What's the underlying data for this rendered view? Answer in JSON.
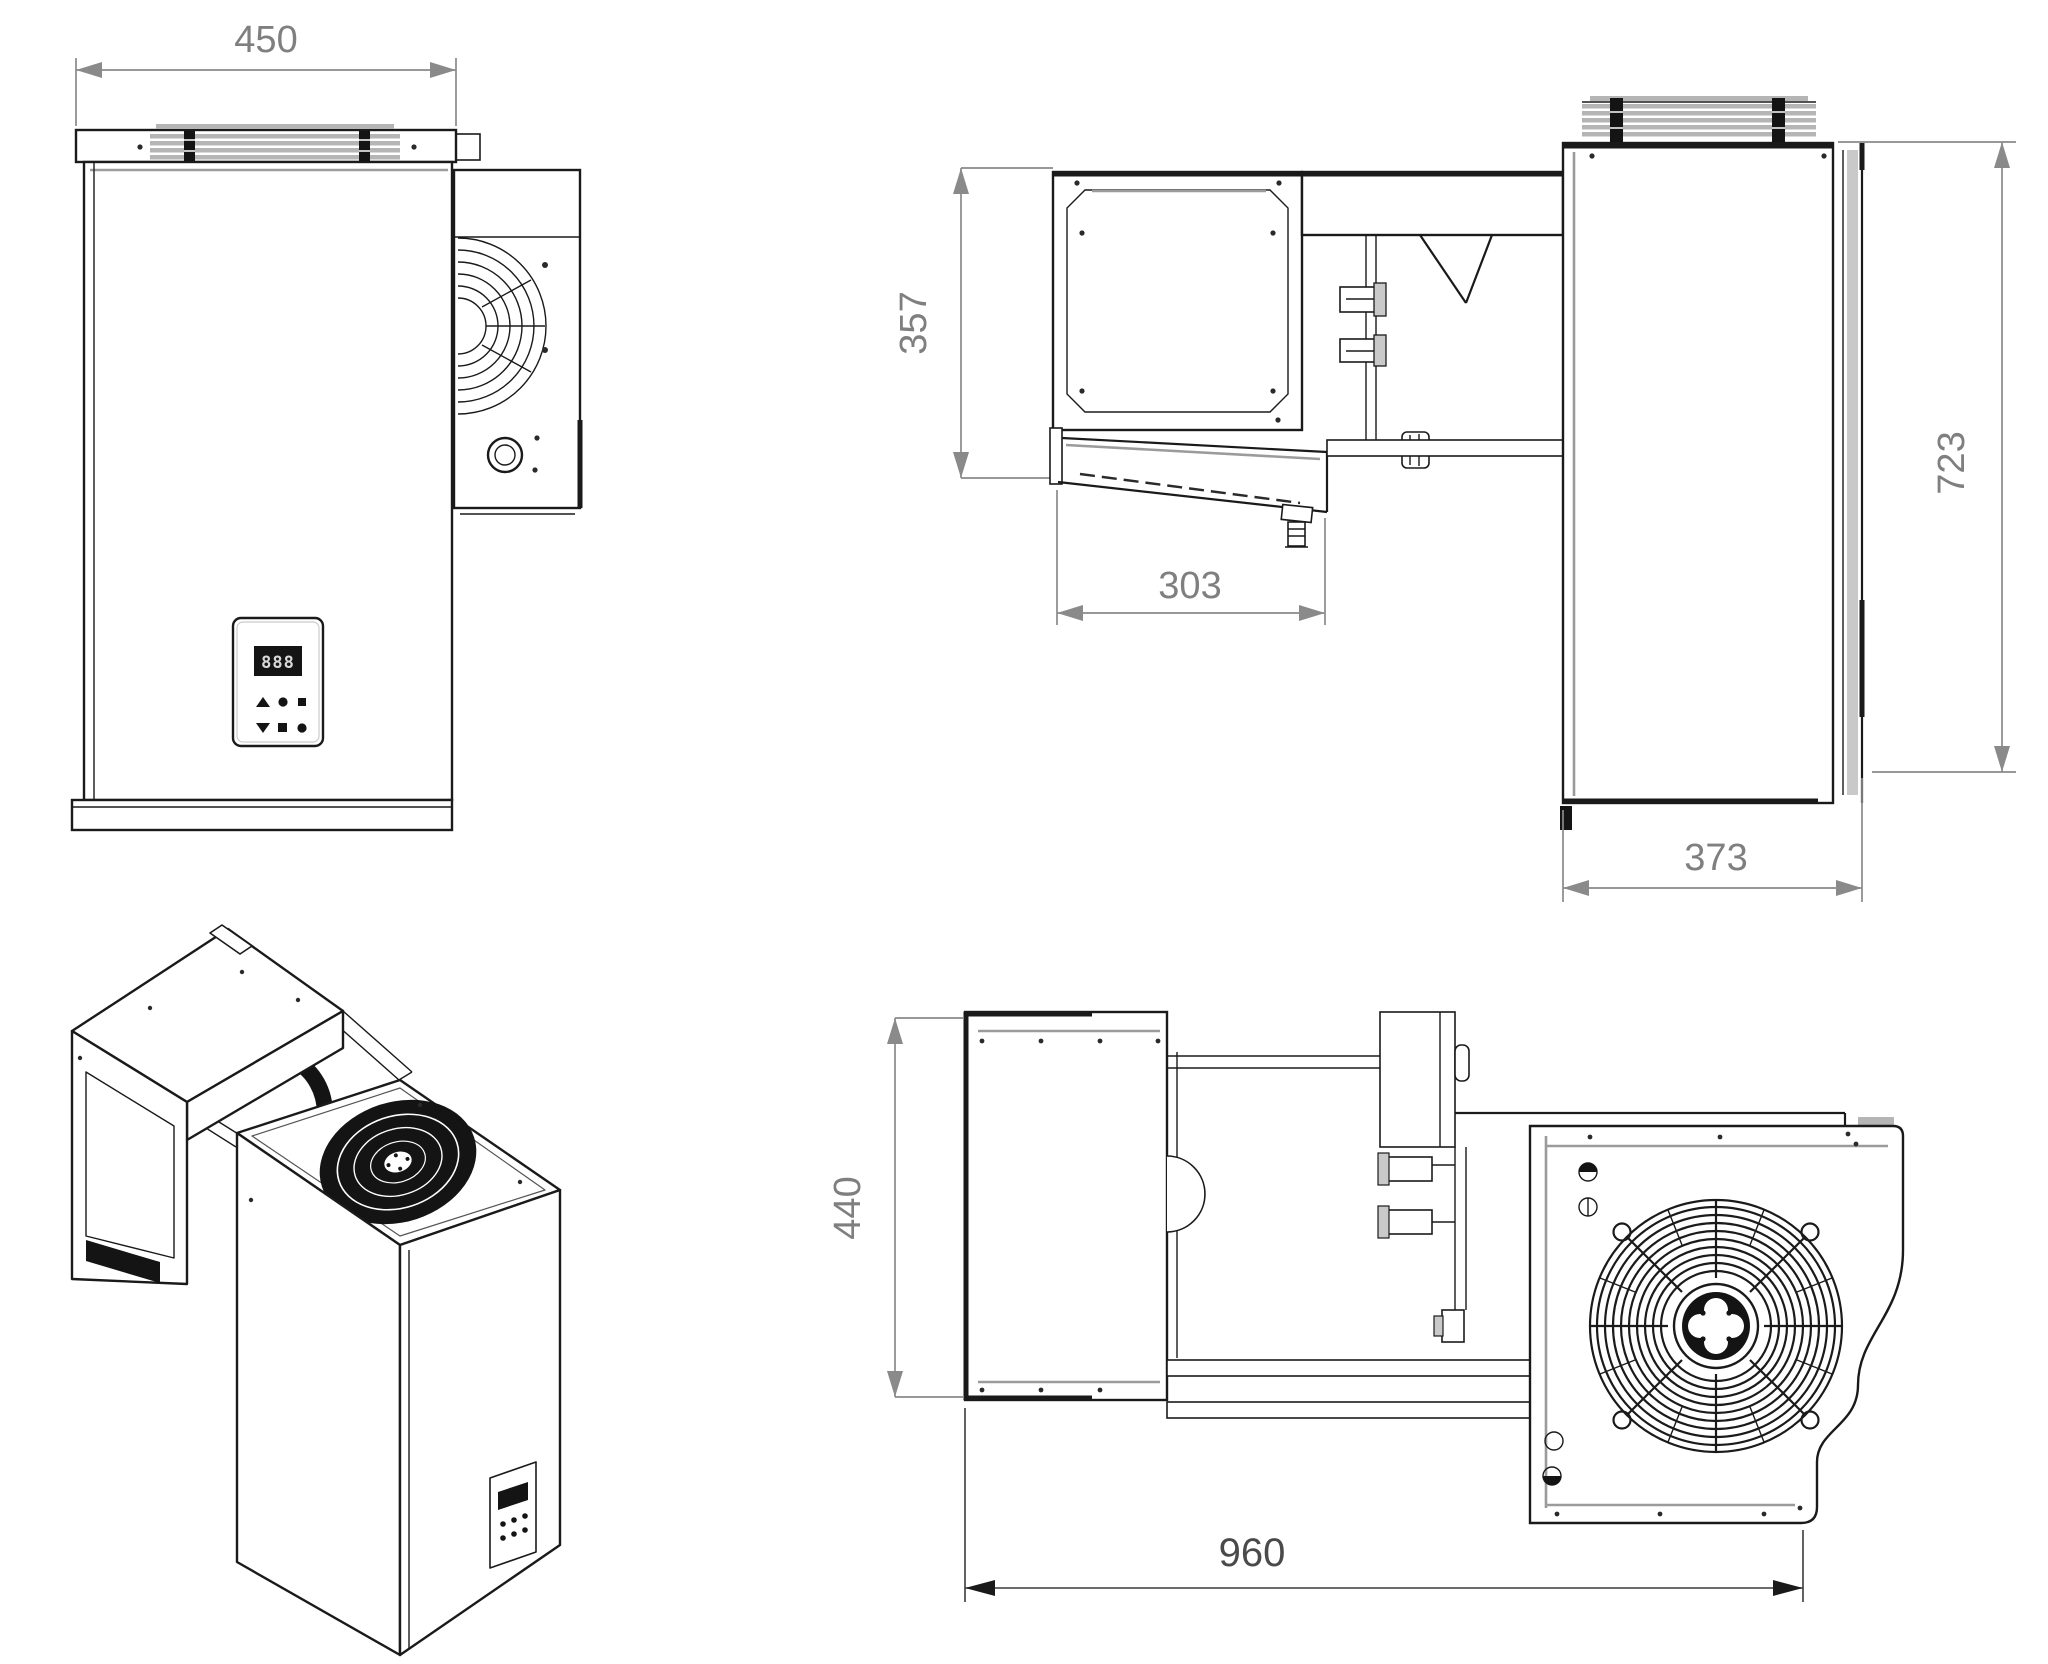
{
  "page": {
    "type": "technical-drawing",
    "subject": "monoblock refrigeration unit - four views (front, side, isometric, top)",
    "background": "#ffffff"
  },
  "dims": {
    "front_width": "450",
    "evaporator_height": "357",
    "evaporator_depth": "303",
    "condenser_height": "723",
    "condenser_depth": "373",
    "unit_width_top": "440",
    "overall_length": "960"
  },
  "display": {
    "digits": "888"
  },
  "colors": {
    "line": "#1a1a1a",
    "dimension_line": "#8a8a8a",
    "dimension_text": "#7f7f7f",
    "louver_gray": "#b5b5b5",
    "dark_fill": "#141414"
  }
}
